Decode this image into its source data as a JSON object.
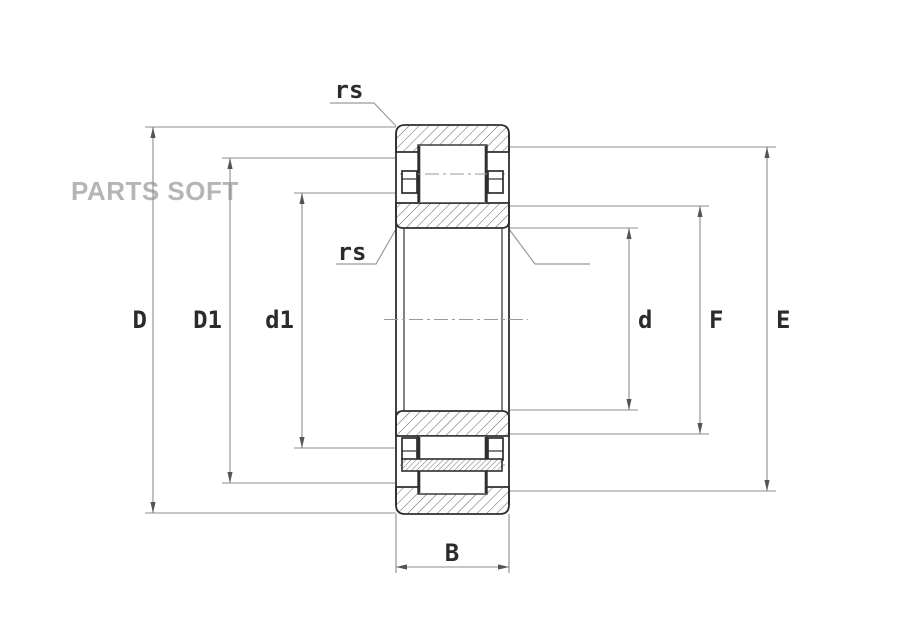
{
  "document": {
    "type": "bearing-technical-drawing",
    "subject": "cylindrical roller bearing cross-section",
    "background_color": "#ffffff",
    "line_color": "#2e2e2e",
    "dimension_line_color": "#8c8c8c",
    "hatch_color": "#5f5f5f"
  },
  "watermark": {
    "text": "PARTS SOFT",
    "color": "#b5b5b5"
  },
  "dimensions": {
    "outer_diameter": {
      "label": "D"
    },
    "shoulder_diameter": {
      "label": "D1"
    },
    "roller_outer": {
      "label": "d1"
    },
    "bore_diameter": {
      "label": "d"
    },
    "rib_diameter": {
      "label": "F"
    },
    "raceway_diameter": {
      "label": "E"
    },
    "width": {
      "label": "B"
    },
    "chamfer_outer": {
      "label": "rs"
    },
    "chamfer_bore": {
      "label": "rs"
    },
    "chamfer_inner_ring": {
      "label": "r1s"
    }
  }
}
